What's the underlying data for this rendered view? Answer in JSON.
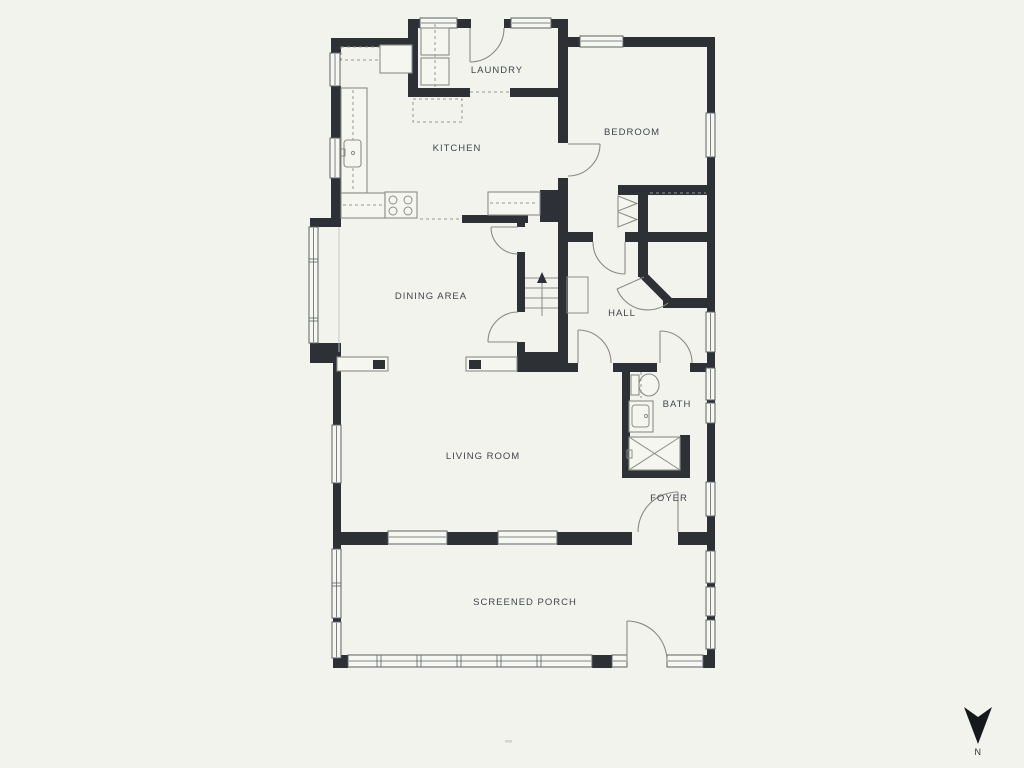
{
  "page": {
    "background": "#f3f3ed"
  },
  "plan": {
    "type": "residential-floor-plan",
    "colors": {
      "wall": "#2d3136",
      "window_frame": "#5d6167",
      "fixture_line": "#8d8d86",
      "door_swing": "#8a8a83",
      "label_text": "#41464c",
      "background": "#f3f3ed"
    },
    "rooms": [
      {
        "id": "laundry",
        "label": "LAUNDRY"
      },
      {
        "id": "kitchen",
        "label": "KITCHEN"
      },
      {
        "id": "bedroom",
        "label": "BEDROOM"
      },
      {
        "id": "dining-area",
        "label": "DINING AREA"
      },
      {
        "id": "hall",
        "label": "HALL"
      },
      {
        "id": "bath",
        "label": "BATH"
      },
      {
        "id": "living-room",
        "label": "LIVING ROOM"
      },
      {
        "id": "foyer",
        "label": "FOYER"
      },
      {
        "id": "screened-porch",
        "label": "SCREENED PORCH"
      }
    ],
    "fixtures": [
      "washer",
      "dryer",
      "kitchen-counter",
      "kitchen-sink",
      "stove",
      "kitchen-island",
      "stairs-up",
      "toilet",
      "bath-sink",
      "bathtub",
      "closet-bifold-door",
      "corner-closet-door",
      "porch-screens"
    ],
    "compass": {
      "label": "N",
      "arrow_direction": "down"
    }
  }
}
